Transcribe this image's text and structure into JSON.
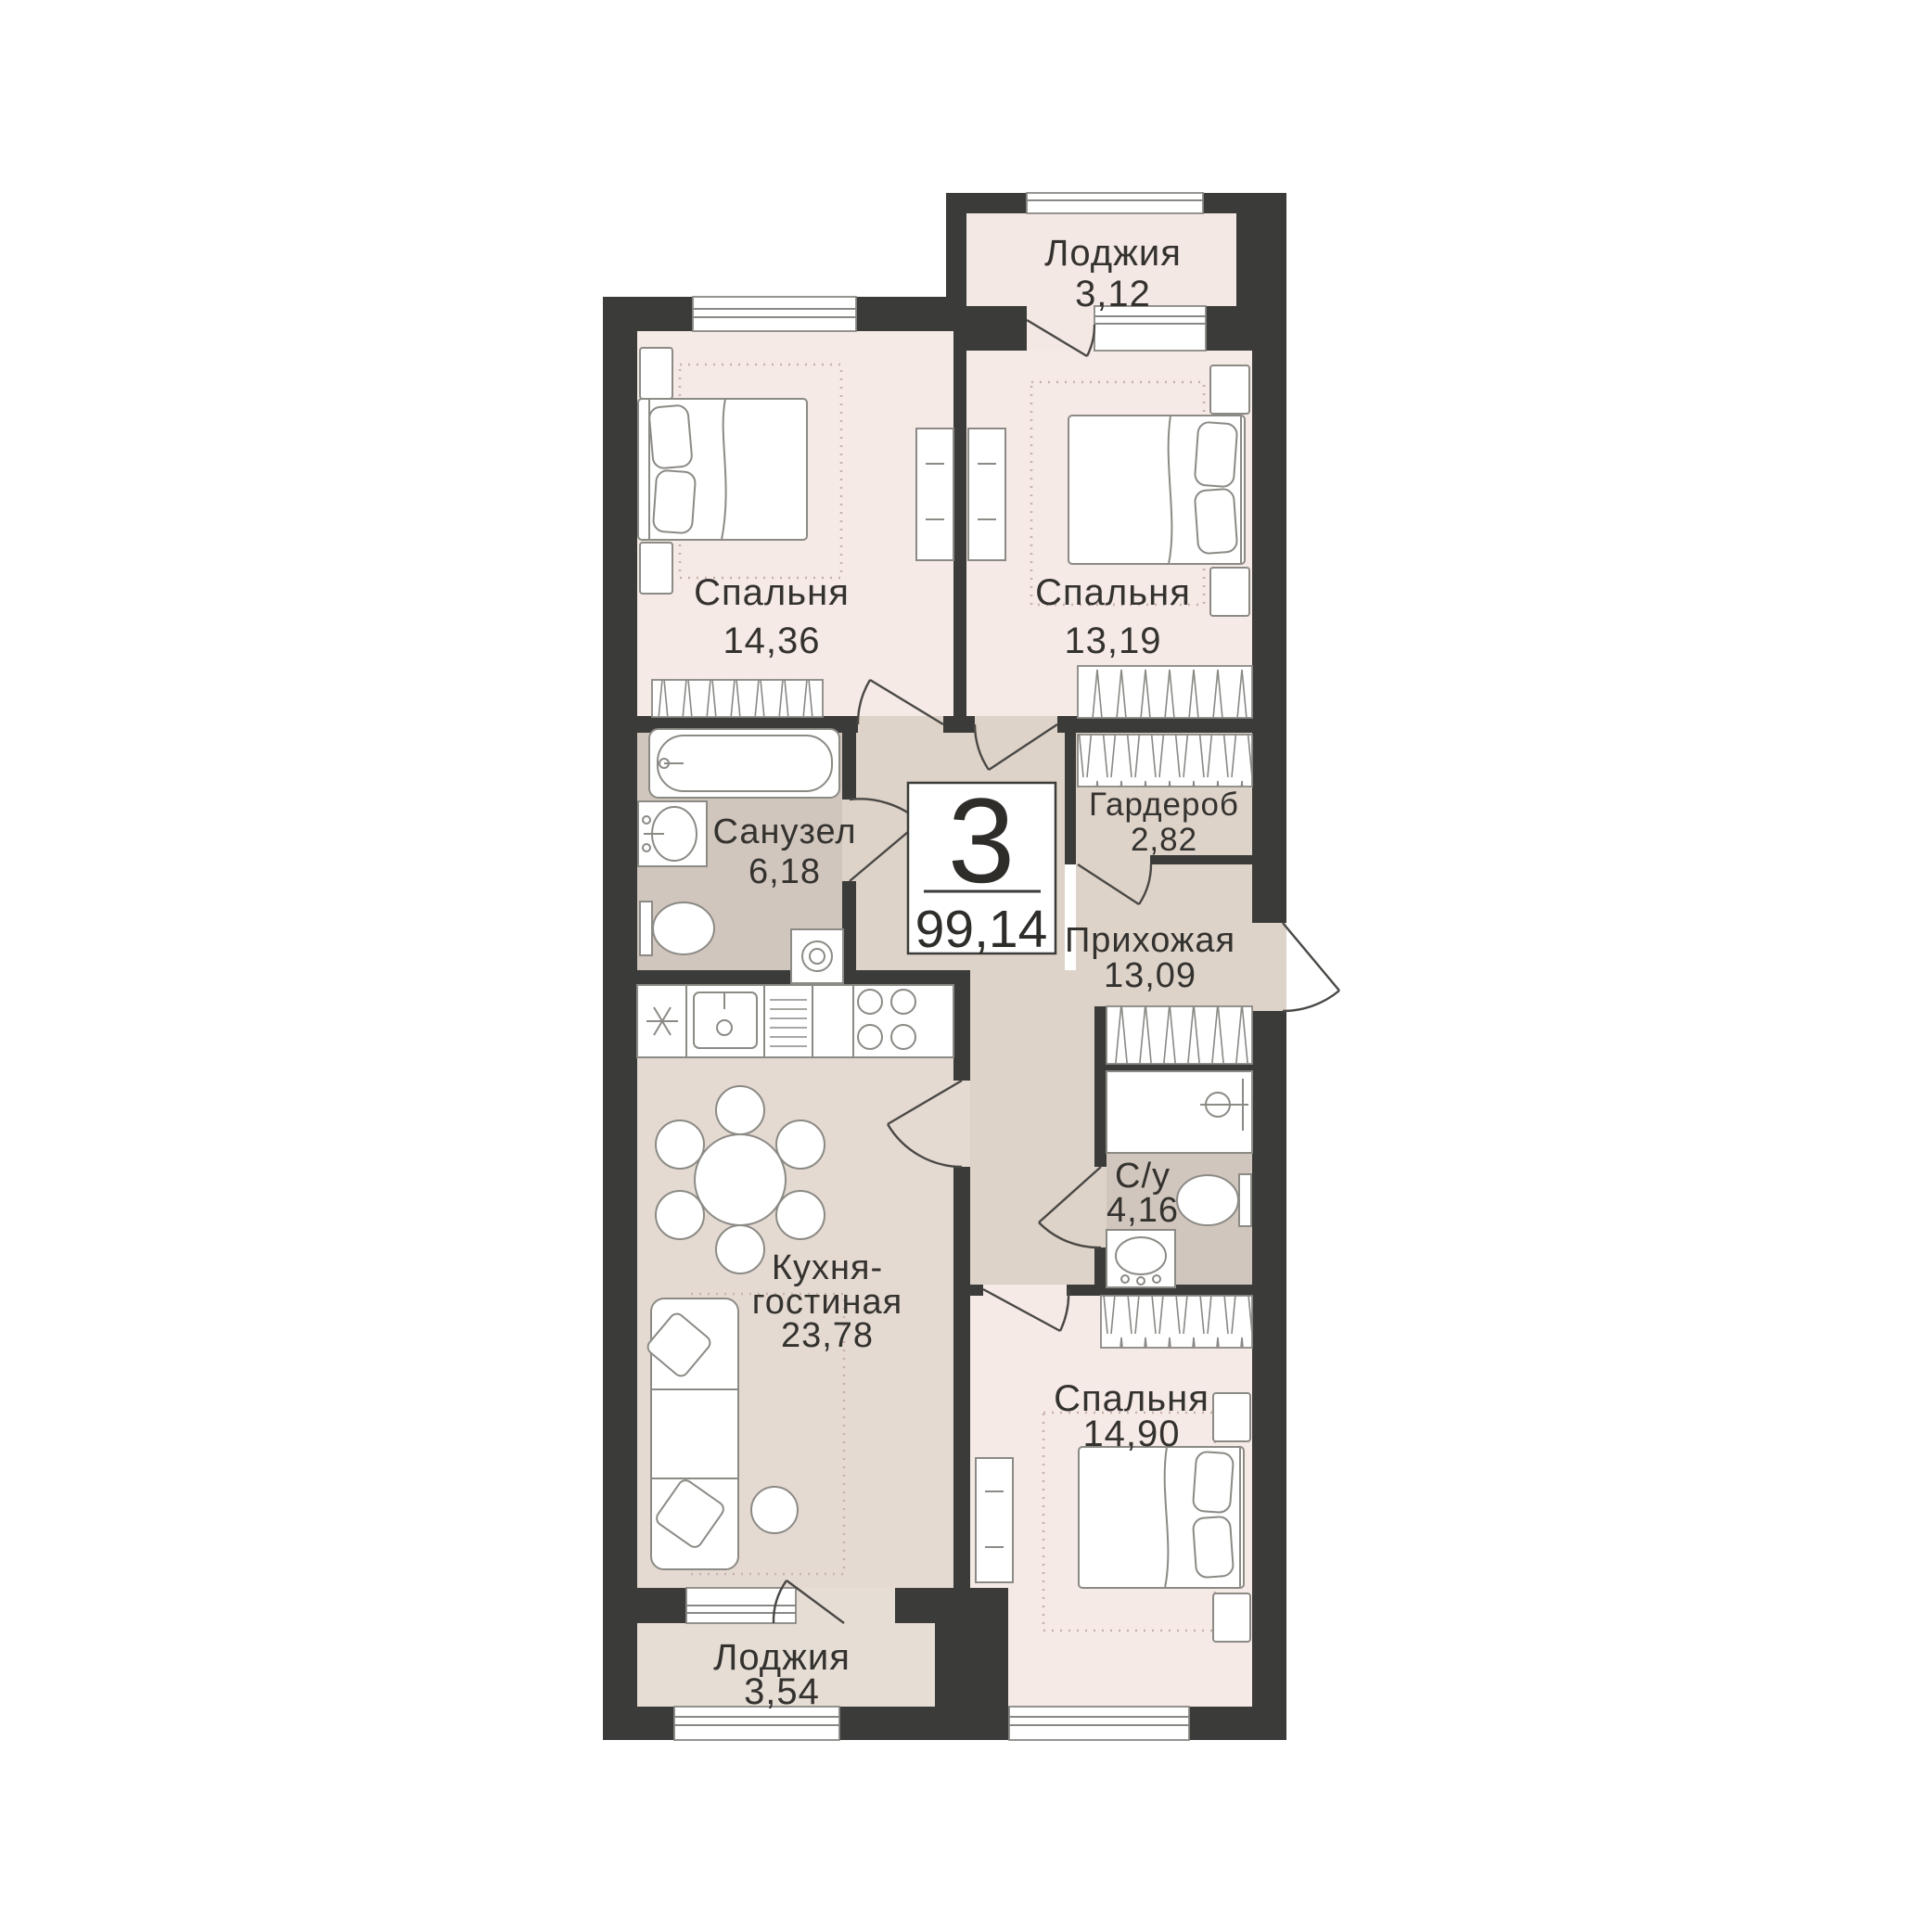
{
  "badge": {
    "rooms_count": "3",
    "total_area": "99,14"
  },
  "rooms": {
    "loggia_top": {
      "name": "Лоджия",
      "area": "3,12"
    },
    "bedroom1": {
      "name": "Спальня",
      "area": "14,36"
    },
    "bedroom2": {
      "name": "Спальня",
      "area": "13,19"
    },
    "bathroom": {
      "name": "Санузел",
      "area": "6,18"
    },
    "wardrobe": {
      "name": "Гардероб",
      "area": "2,82"
    },
    "hallway": {
      "name": "Прихожая",
      "area": "13,09"
    },
    "wc": {
      "name": "С/у",
      "area": "4,16"
    },
    "kitchen_living": {
      "name_line1": "Кухня-",
      "name_line2": "гостиная",
      "area": "23,78"
    },
    "bedroom3": {
      "name": "Спальня",
      "area": "14,90"
    },
    "loggia_bottom": {
      "name": "Лоджия",
      "area": "3,54"
    }
  },
  "colors": {
    "wall": "#3b3b39",
    "bedroom_floor": "#f5eae5",
    "loggia_top_floor": "#f3e8e3",
    "loggia_bottom_floor": "#e6ddd5",
    "hallway_floor": "#ddd3c9",
    "bathroom_floor": "#d0c6bd",
    "kitchen_floor": "#e4dad2",
    "label_text": "#34322f",
    "furniture_line": "#8c8a85"
  }
}
